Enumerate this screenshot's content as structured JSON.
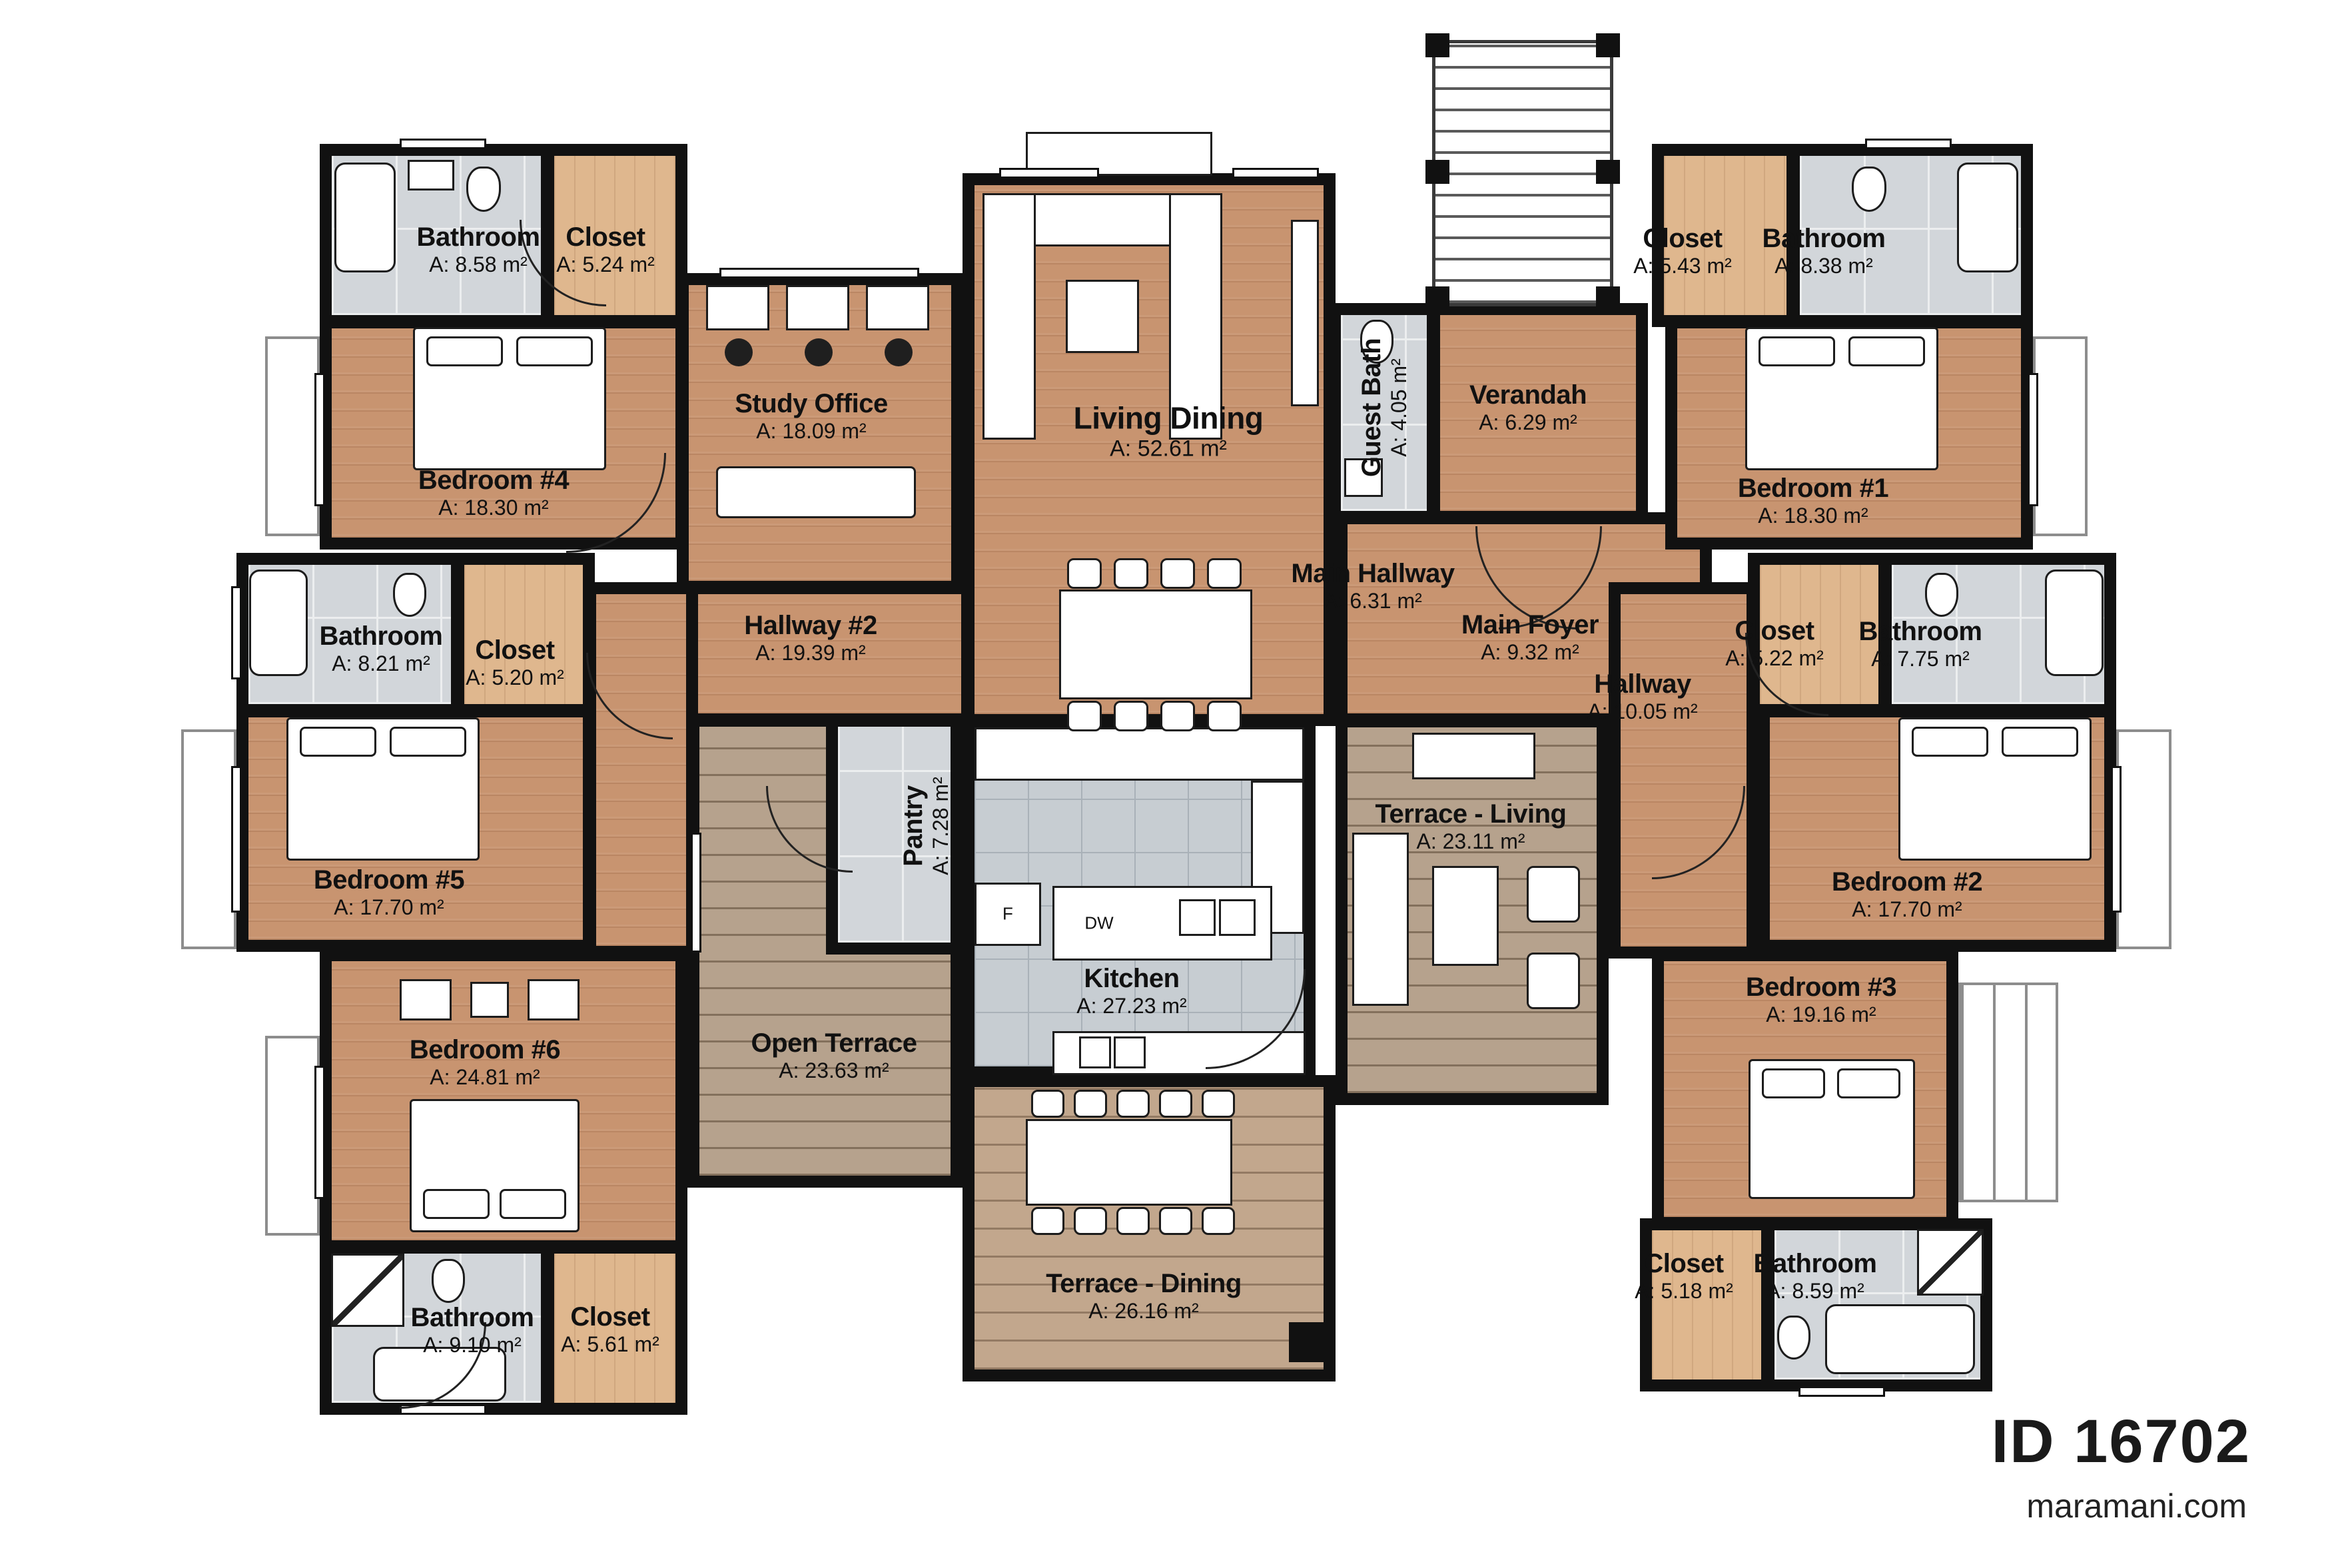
{
  "branding": {
    "plan_id": "ID 16702",
    "website": "maramani.com"
  },
  "appliances": {
    "dishwasher": "DW",
    "fridge": "F"
  },
  "colors": {
    "wall": "#111111",
    "wood": "#c89470",
    "wood_light": "#dfb78e",
    "tile": "#d2d6da",
    "kitchen_tile": "#c7cdd2",
    "deck": "#b6a28d",
    "deck_dining": "#c2a78d"
  },
  "rooms": [
    {
      "name": "Bathroom",
      "area": "A: 8.58 m²"
    },
    {
      "name": "Closet",
      "area": "A: 5.24 m²"
    },
    {
      "name": "Bedroom #4",
      "area": "A: 18.30 m²"
    },
    {
      "name": "Study Office",
      "area": "A: 18.09 m²"
    },
    {
      "name": "Living Dining",
      "area": "A: 52.61 m²"
    },
    {
      "name": "Guest Bath",
      "area": "A: 4.05 m²"
    },
    {
      "name": "Verandah",
      "area": "A: 6.29 m²"
    },
    {
      "name": "Closet",
      "area": "A: 5.43 m²"
    },
    {
      "name": "Bathroom",
      "area": "A: 8.38 m²"
    },
    {
      "name": "Bedroom #1",
      "area": "A: 18.30 m²"
    },
    {
      "name": "Bathroom",
      "area": "A: 8.21 m²"
    },
    {
      "name": "Closet",
      "area": "A: 5.20 m²"
    },
    {
      "name": "Main Hallway",
      "area": "A: 6.31 m²"
    },
    {
      "name": "Main Foyer",
      "area": "A: 9.32 m²"
    },
    {
      "name": "Hallway",
      "area": "A: 10.05 m²"
    },
    {
      "name": "Closet",
      "area": "A: 5.22 m²"
    },
    {
      "name": "Bathroom",
      "area": "A: 7.75 m²"
    },
    {
      "name": "Hallway #2",
      "area": "A: 19.39 m²"
    },
    {
      "name": "Bedroom #5",
      "area": "A: 17.70 m²"
    },
    {
      "name": "Pantry",
      "area": "A: 7.28 m²"
    },
    {
      "name": "Terrace - Living",
      "area": "A: 23.11 m²"
    },
    {
      "name": "Bedroom #2",
      "area": "A: 17.70 m²"
    },
    {
      "name": "Bedroom #6",
      "area": "A: 24.81 m²"
    },
    {
      "name": "Open Terrace",
      "area": "A: 23.63 m²"
    },
    {
      "name": "Kitchen",
      "area": "A: 27.23 m²"
    },
    {
      "name": "Bedroom #3",
      "area": "A: 19.16 m²"
    },
    {
      "name": "Bathroom",
      "area": "A: 9.10 m²"
    },
    {
      "name": "Closet",
      "area": "A: 5.61 m²"
    },
    {
      "name": "Terrace - Dining",
      "area": "A: 26.16 m²"
    },
    {
      "name": "Closet",
      "area": "A: 5.18 m²"
    },
    {
      "name": "Bathroom",
      "area": "A: 8.59 m²"
    }
  ]
}
